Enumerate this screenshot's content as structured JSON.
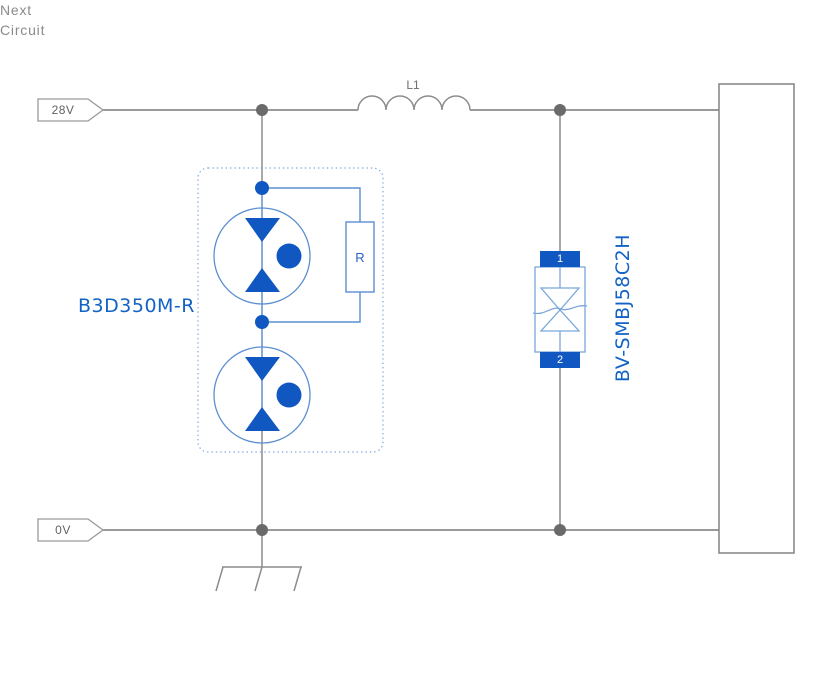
{
  "diagram": {
    "power_rails": {
      "top_label": "28V",
      "bottom_label": "0V"
    },
    "inductor": {
      "label": "L1"
    },
    "surge_module": {
      "label": "B3D350M-R",
      "resistor_label": "R"
    },
    "tvs_diode": {
      "label": "BV-SMBJ58C2H",
      "pin1": "1",
      "pin2": "2"
    },
    "next_circuit": {
      "label": "Next\nCircuit"
    },
    "colors": {
      "component_blue": "#1157c1",
      "component_light_blue": "#5b8fd0",
      "label_blue": "#1263c6",
      "wire_gray": "#8c8c8c",
      "junction_gray": "#6a6a6a",
      "text_gray": "#8a8a8a"
    }
  }
}
